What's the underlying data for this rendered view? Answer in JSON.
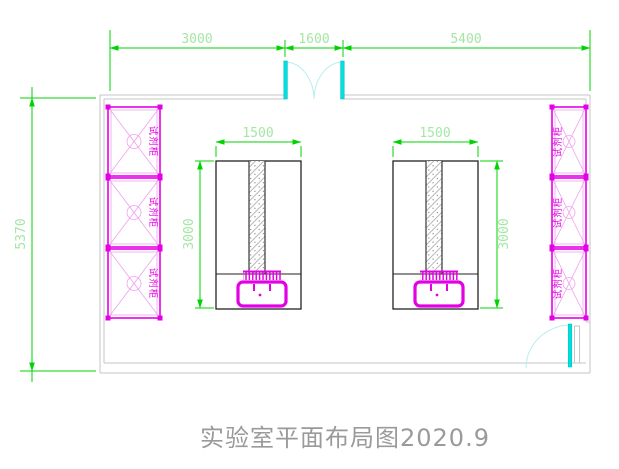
{
  "drawing": {
    "title": "实验室平面布局图2020.9"
  },
  "dims": {
    "top": [
      "3000",
      "1600",
      "5400"
    ],
    "room_height": "5370",
    "bench_width": "1500",
    "bench_depth": "3000"
  },
  "cabinets": {
    "label": "试剂柜",
    "left_count": 3,
    "right_count": 3
  },
  "colors": {
    "background": "#ffffff",
    "dimension": "#00d400",
    "dim_text": "#a5e6a5",
    "cabinet": "#e400e4",
    "cabinet_light": "#f0a0f0",
    "door": "#00e0e0",
    "door_arc": "#b5eeee",
    "wall": "#c6c6c6",
    "bench": "#222222",
    "title_text": "#9a9a9a"
  }
}
